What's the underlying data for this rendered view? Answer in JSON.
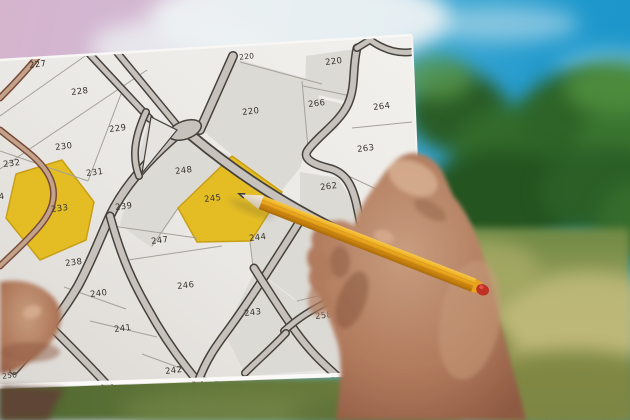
{
  "scene": {
    "type": "photograph",
    "description": "Close-up of hands holding a cadastral parcel map outdoors; a yellow pencil with a broken red end points at highlighted yellow parcel 245; pink-to-cyan sky with clouds above, blurred green trees and olive grass behind",
    "pointed_parcel": "245",
    "highlighted_parcels": [
      "233",
      "245"
    ]
  },
  "map": {
    "parcels": [
      {
        "id": "227"
      },
      {
        "id": "228"
      },
      {
        "id": "229"
      },
      {
        "id": "230"
      },
      {
        "id": "232"
      },
      {
        "id": "231"
      },
      {
        "id": "233",
        "highlighted": true
      },
      {
        "id": "239"
      },
      {
        "id": "248"
      },
      {
        "id": "245",
        "highlighted": true
      },
      {
        "id": "247"
      },
      {
        "id": "244"
      },
      {
        "id": "238"
      },
      {
        "id": "240"
      },
      {
        "id": "246"
      },
      {
        "id": "241"
      },
      {
        "id": "242"
      },
      {
        "id": "243"
      },
      {
        "id": "258"
      },
      {
        "id": "262"
      },
      {
        "id": "263"
      },
      {
        "id": "264"
      },
      {
        "id": "266"
      },
      {
        "id": "220"
      },
      {
        "id": "220"
      },
      {
        "id": "220",
        "partial": true
      },
      {
        "id": "4",
        "partial": true
      },
      {
        "id": "250",
        "partial": true
      }
    ]
  },
  "colors": {
    "highlight_yellow": "#e4bd25",
    "paper": "#edebe7",
    "parcel_gray": "#dcdad5",
    "road_fill": "#c7c2bb",
    "road_edge": "#46413b",
    "brown_road_fill": "#c2a28b",
    "brown_road_edge": "#7a4a38",
    "boundary_line": "#a5a19b",
    "label_text": "#38342f",
    "pencil_yellow": "#eaa71e",
    "pencil_end_red": "#c03024",
    "sky_cyan": "#1e98cc",
    "sky_pink": "#c4a8c2",
    "cloud_white": "#edf2f4",
    "tree_green": "#2e6428",
    "grass_olive": "#9aa05c",
    "skin": "#b98a6e"
  }
}
